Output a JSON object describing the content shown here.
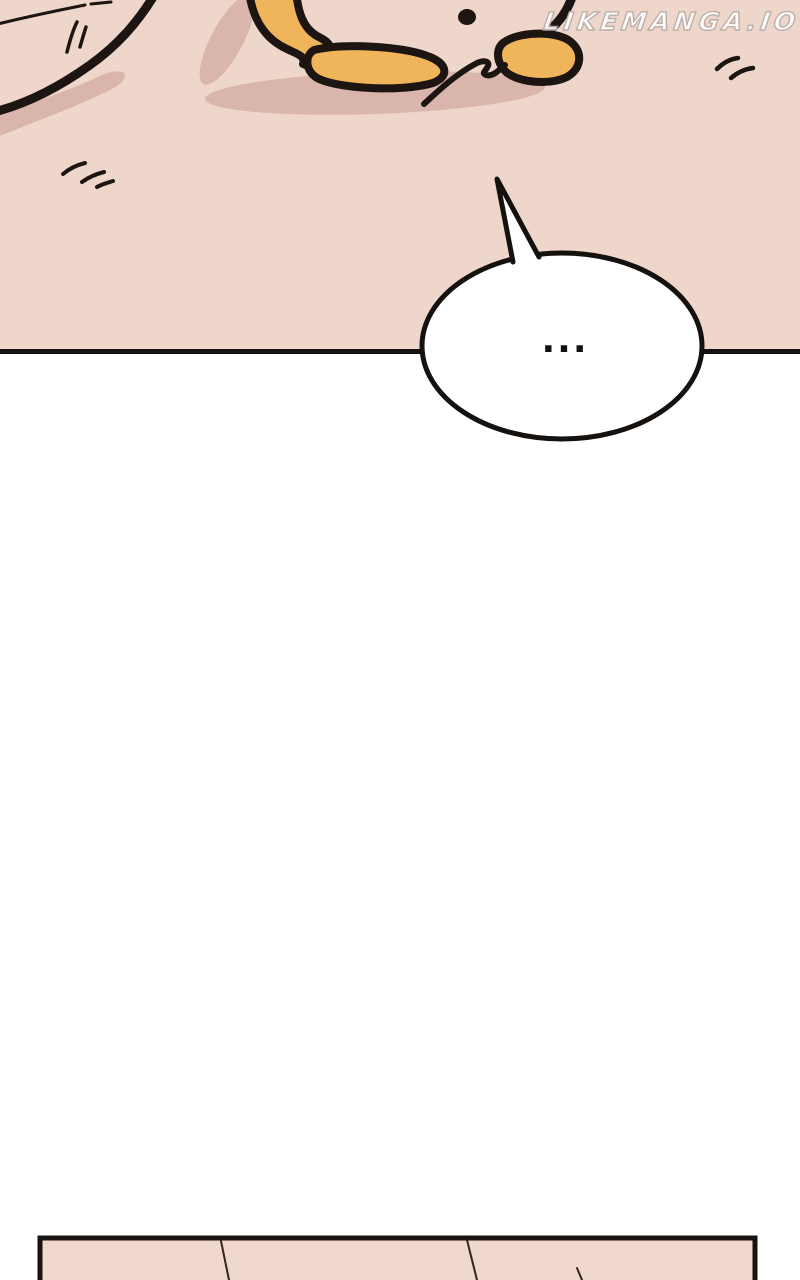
{
  "watermark": {
    "text": "LIKEMANGA.IO",
    "color": "#ffffff",
    "outline_color": "#b7aca7"
  },
  "speech_bubble": {
    "text": "...",
    "fill": "#ffffff",
    "stroke": "#15110e"
  },
  "scene": {
    "background": "#eed6cb",
    "shadow_color": "#d9b5ab",
    "character_color": "#f0b45a",
    "outline_color": "#1c1512",
    "divider_color": "#161110"
  },
  "bottom_panel": {
    "fill": "#f0d9cc",
    "border": "#181310",
    "seam_color": "#33251d"
  },
  "canvas": {
    "background": "#ffffff"
  }
}
